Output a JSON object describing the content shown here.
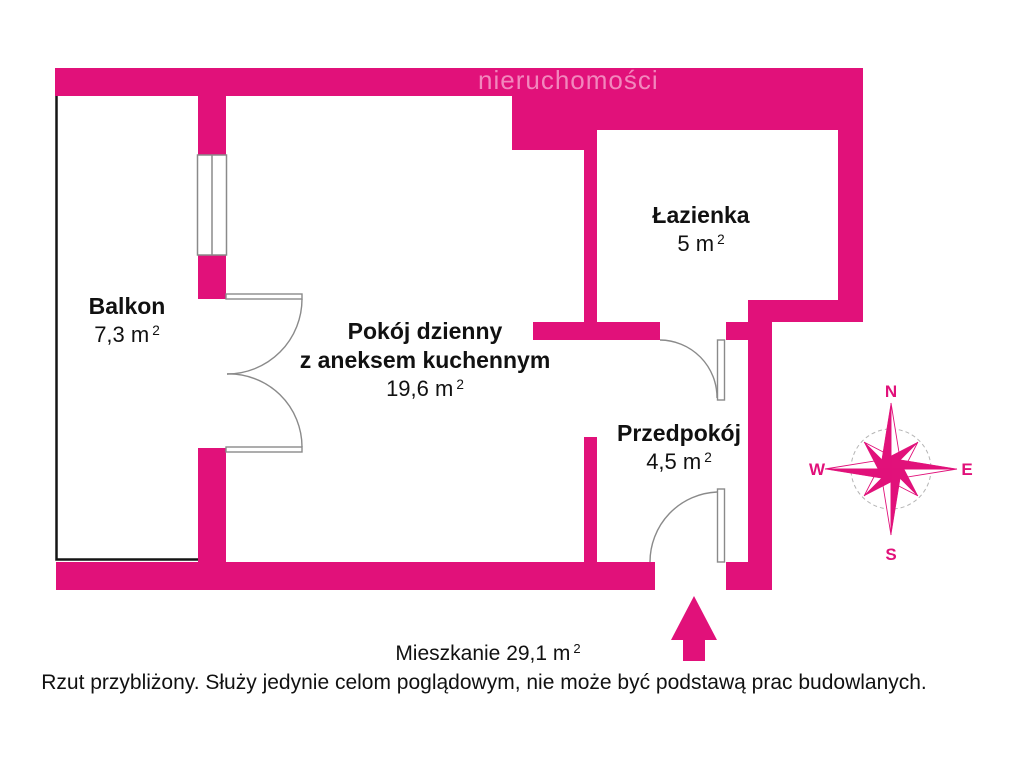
{
  "watermark": "nieruchomości",
  "colors": {
    "wall": "#e1117a",
    "text": "#111111",
    "watermark": "#f287bd",
    "door_line": "#8a8a8a"
  },
  "rooms": {
    "balkon": {
      "name": "Balkon",
      "area": "7,3",
      "unit": "m",
      "sup": "2"
    },
    "pokoj": {
      "name": "Pokój dzienny",
      "name2": "z aneksem kuchennym",
      "area": "19,6",
      "unit": "m",
      "sup": "2"
    },
    "lazienka": {
      "name": "Łazienka",
      "area": "5",
      "unit": "m",
      "sup": "2"
    },
    "przedpokoj": {
      "name": "Przedpokój",
      "area": "4,5",
      "unit": "m",
      "sup": "2"
    }
  },
  "compass": {
    "n": "N",
    "e": "E",
    "s": "S",
    "w": "W"
  },
  "footer": {
    "summary_prefix": "Mieszkanie",
    "summary_area": "29,1",
    "summary_unit": "m",
    "summary_sup": "2",
    "disclaimer": "Rzut przybliżony. Służy jedynie celom poglądowym, nie może być podstawą prac budowlanych."
  }
}
